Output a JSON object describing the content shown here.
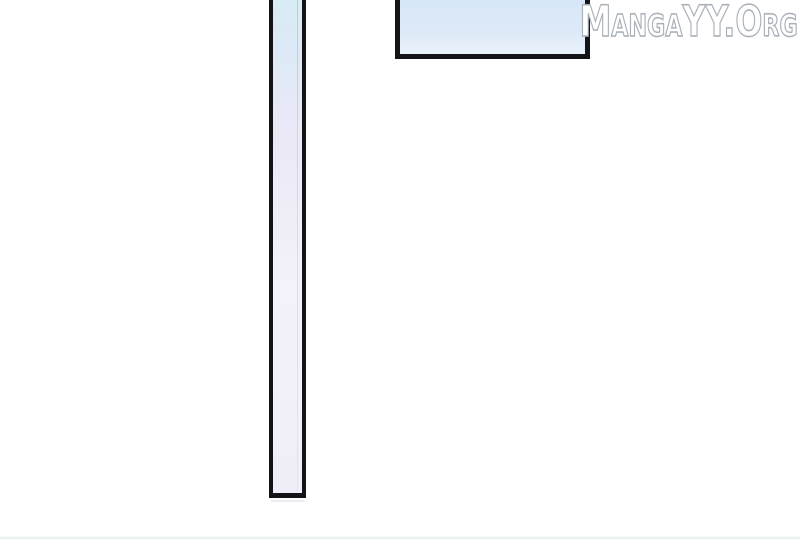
{
  "watermark": {
    "text": "MangaYY.Org"
  },
  "panels": {
    "vertical": {
      "description": "tall narrow empty manga panel, top cropped off-screen"
    },
    "top_right": {
      "description": "wide short sky-blue manga panel, top cropped off-screen"
    }
  },
  "colors": {
    "background": "#ffffff",
    "panel_border": "#141418",
    "watermark_fill": "#ffffff",
    "watermark_outline": "#aab0b8",
    "vertical_panel_top": "#d7ecf3",
    "vertical_panel_mid": "#ece9f7",
    "vertical_panel_bottom": "#f3f1fa",
    "topright_panel_top": "#d7e7f7",
    "topright_panel_bottom": "#e9f1fa",
    "bottom_strip_tint": "rgba(198,216,205,0.5)"
  }
}
